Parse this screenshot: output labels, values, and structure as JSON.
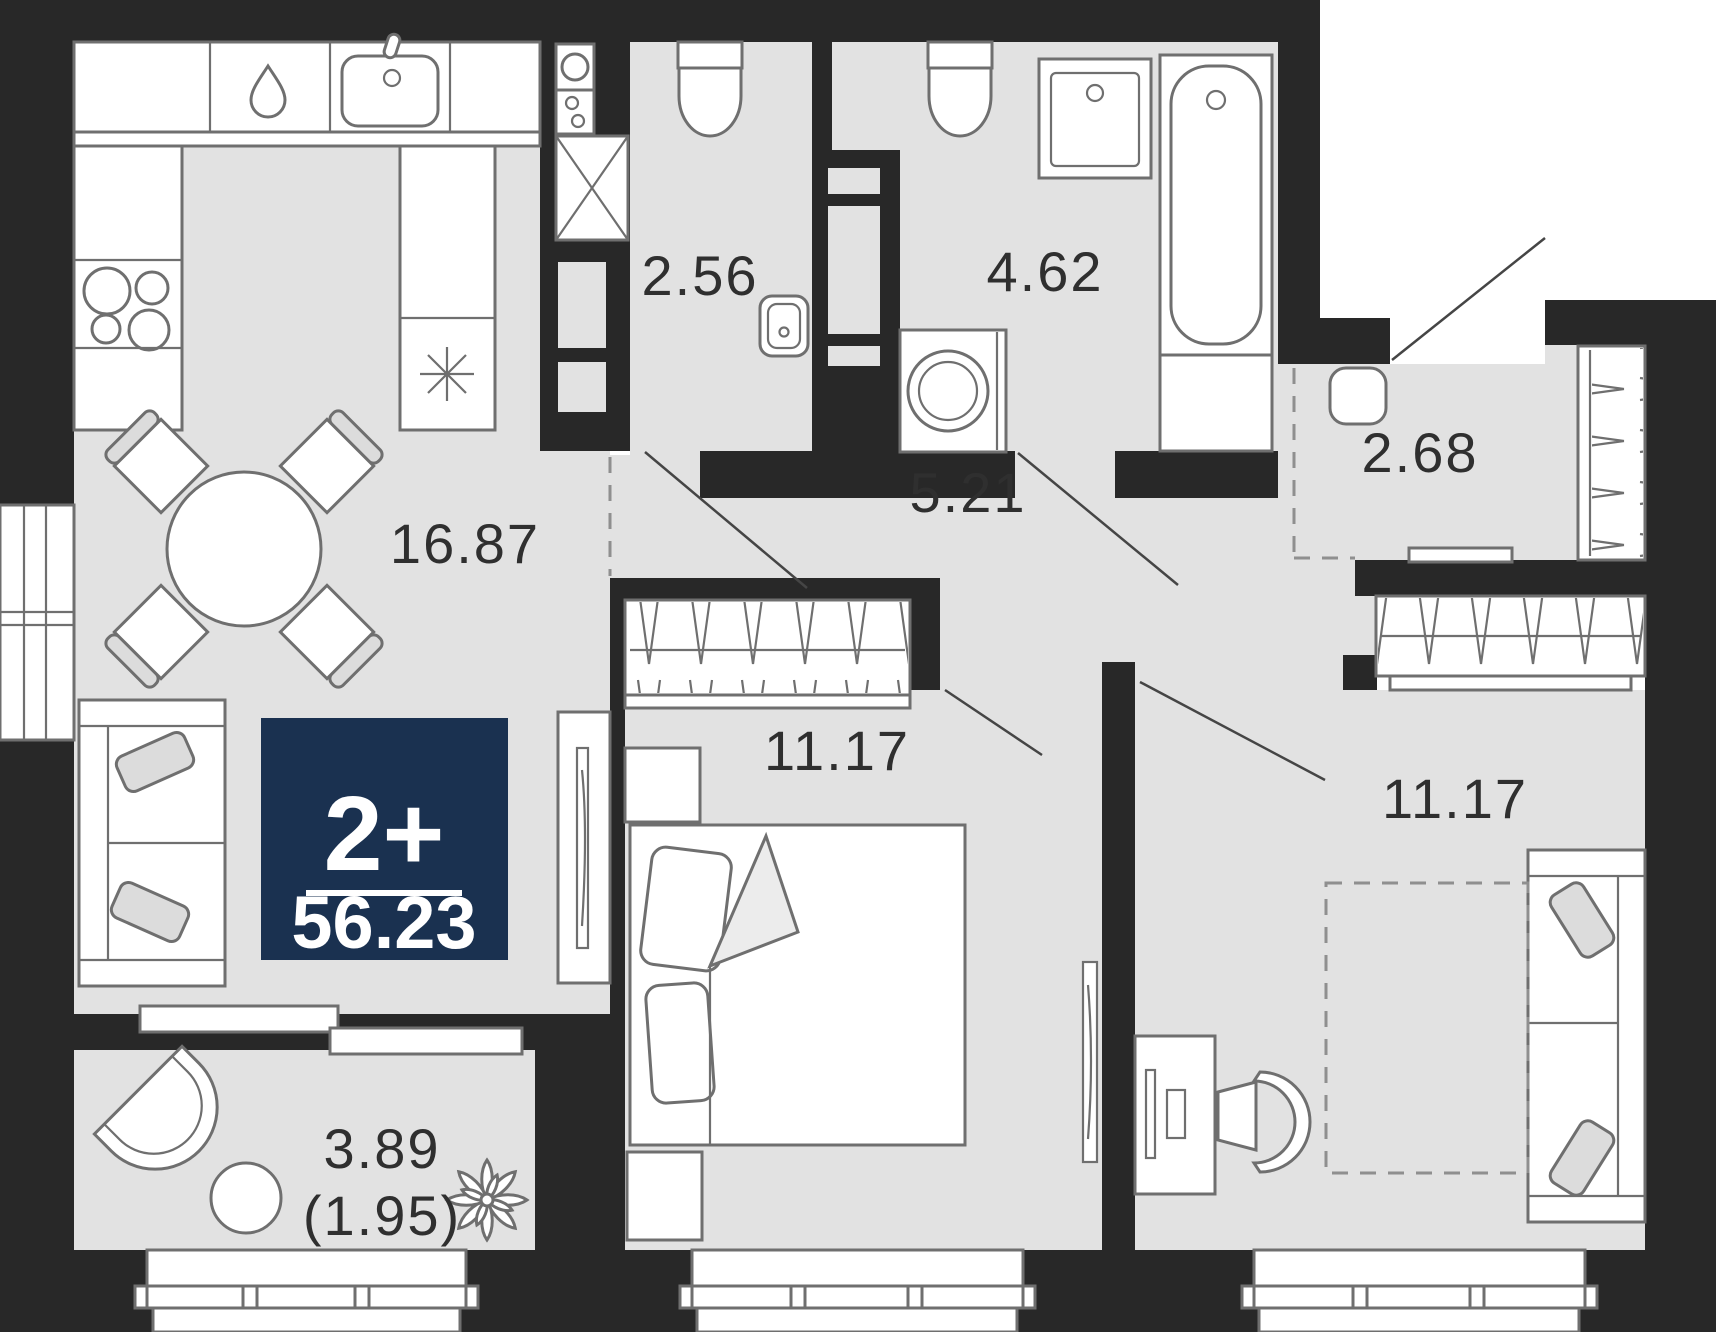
{
  "badge": {
    "rooms": "2+",
    "area_total": "56.23"
  },
  "rooms": {
    "kitchen_living": {
      "label": "16.87"
    },
    "toilet": {
      "label": "2.56"
    },
    "bathroom": {
      "label": "4.62"
    },
    "hallway": {
      "label": "5.21"
    },
    "entry": {
      "label": "2.68"
    },
    "bedroom_main": {
      "label": "11.17"
    },
    "bedroom_second": {
      "label": "11.17"
    },
    "balcony": {
      "label": "3.89",
      "label_secondary": "(1.95)"
    }
  },
  "colors": {
    "wall": "#282828",
    "floor": "#e2e2e2",
    "line": "#6f6f6f",
    "badge": "#1a3150",
    "text": "#2f2f2f"
  },
  "icons": {
    "fridge": "snowflake-icon",
    "dishwasher": "drop-icon",
    "ventilation": "vent-circle-icon",
    "decor": "plant-icon"
  }
}
